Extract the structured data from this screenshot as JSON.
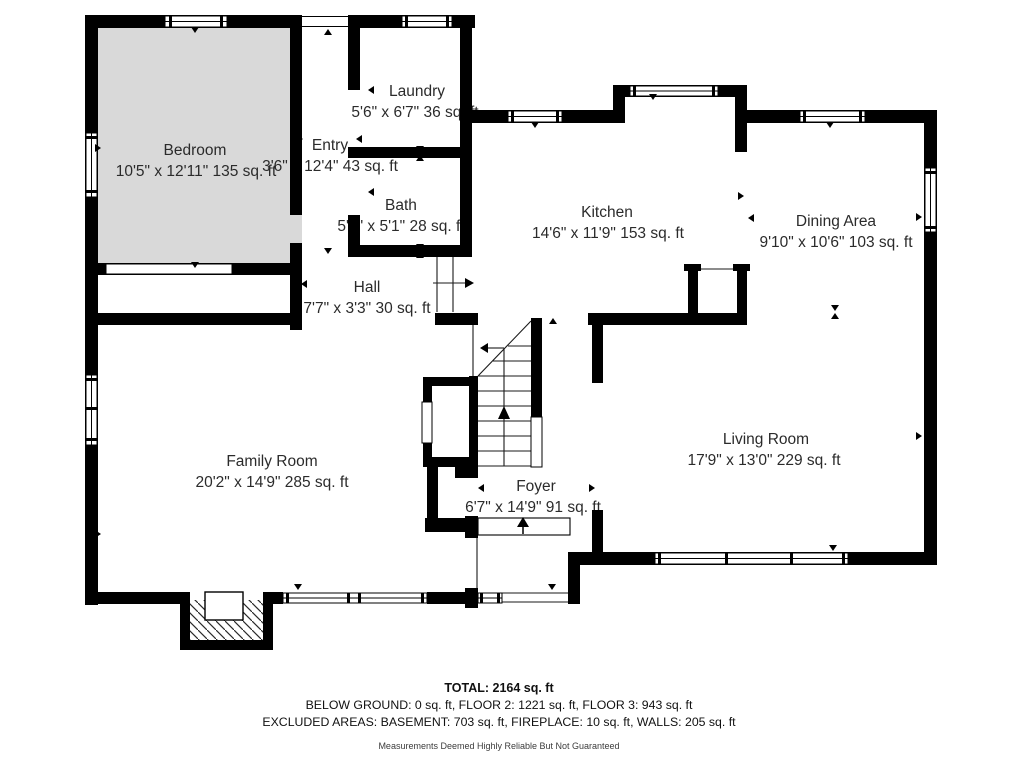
{
  "plan": {
    "rooms": [
      {
        "id": "bedroom",
        "name": "Bedroom",
        "dims": "10'5\" x 12'11\" 135 sq. ft"
      },
      {
        "id": "entry",
        "name": "Entry",
        "dims": "3'6\" x 12'4\" 43 sq. ft"
      },
      {
        "id": "laundry",
        "name": "Laundry",
        "dims": "5'6\" x 6'7\" 36 sq. ft"
      },
      {
        "id": "bath",
        "name": "Bath",
        "dims": "5'6\" x 5'1\" 28 sq. ft"
      },
      {
        "id": "kitchen",
        "name": "Kitchen",
        "dims": "14'6\" x 11'9\" 153 sq. ft"
      },
      {
        "id": "dining",
        "name": "Dining Area",
        "dims": "9'10\" x 10'6\" 103 sq. ft"
      },
      {
        "id": "hall",
        "name": "Hall",
        "dims": "7'7\" x 3'3\" 30 sq. ft"
      },
      {
        "id": "family",
        "name": "Family Room",
        "dims": "20'2\" x 14'9\" 285 sq. ft"
      },
      {
        "id": "foyer",
        "name": "Foyer",
        "dims": "6'7\" x 14'9\" 91 sq. ft"
      },
      {
        "id": "living",
        "name": "Living Room",
        "dims": "17'9\" x 13'0\" 229 sq. ft"
      }
    ],
    "summary": {
      "total": "TOTAL: 2164 sq. ft",
      "floors": "BELOW GROUND: 0 sq. ft, FLOOR 2: 1221 sq. ft, FLOOR 3: 943 sq. ft",
      "excluded": "EXCLUDED AREAS: BASEMENT: 703 sq. ft, FIREPLACE: 10 sq. ft, WALLS: 205 sq. ft",
      "disclaimer": "Measurements Deemed Highly Reliable But Not Guaranteed"
    },
    "colors": {
      "wall": "#000000",
      "bedroom_fill": "#d9d9d9",
      "text": "#2b2b2b",
      "background": "#ffffff"
    }
  }
}
